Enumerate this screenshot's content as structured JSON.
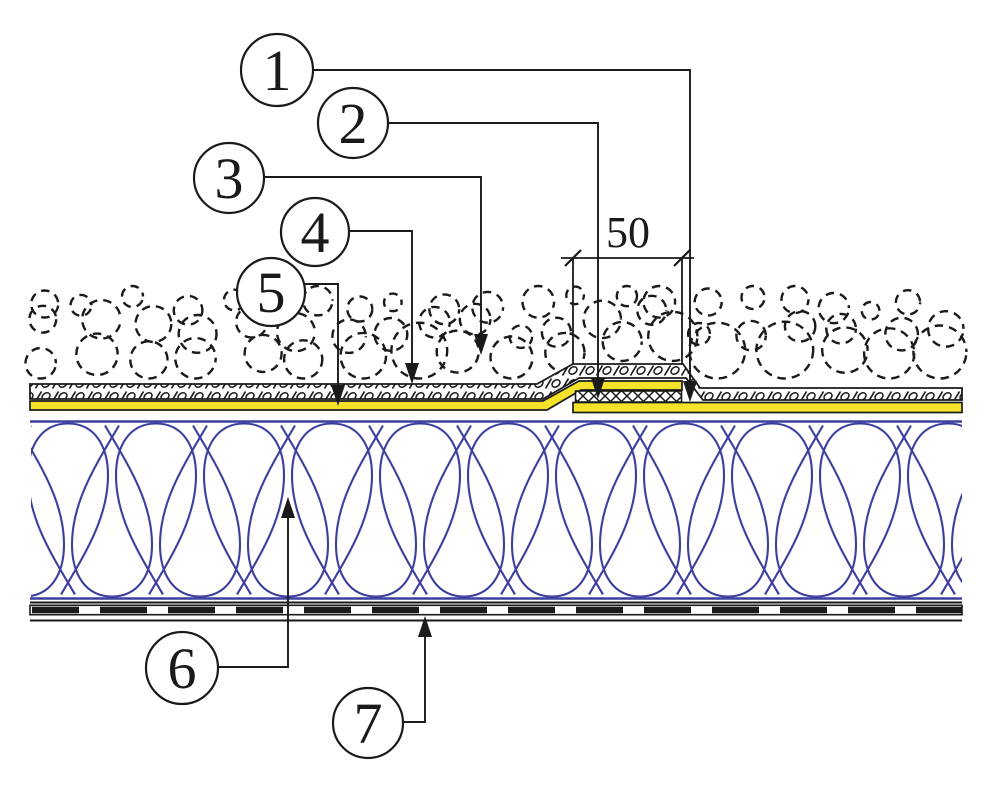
{
  "diagram": {
    "dimension": {
      "label": "50"
    },
    "callouts": [
      {
        "label": "1"
      },
      {
        "label": "2"
      },
      {
        "label": "3"
      },
      {
        "label": "4"
      },
      {
        "label": "5"
      },
      {
        "label": "6"
      },
      {
        "label": "7"
      }
    ],
    "colors": {
      "membrane_yellow": "#f5e32b",
      "insulation_blue": "#3b3f9e",
      "ink": "#1a1a1a",
      "background": "#ffffff"
    }
  }
}
